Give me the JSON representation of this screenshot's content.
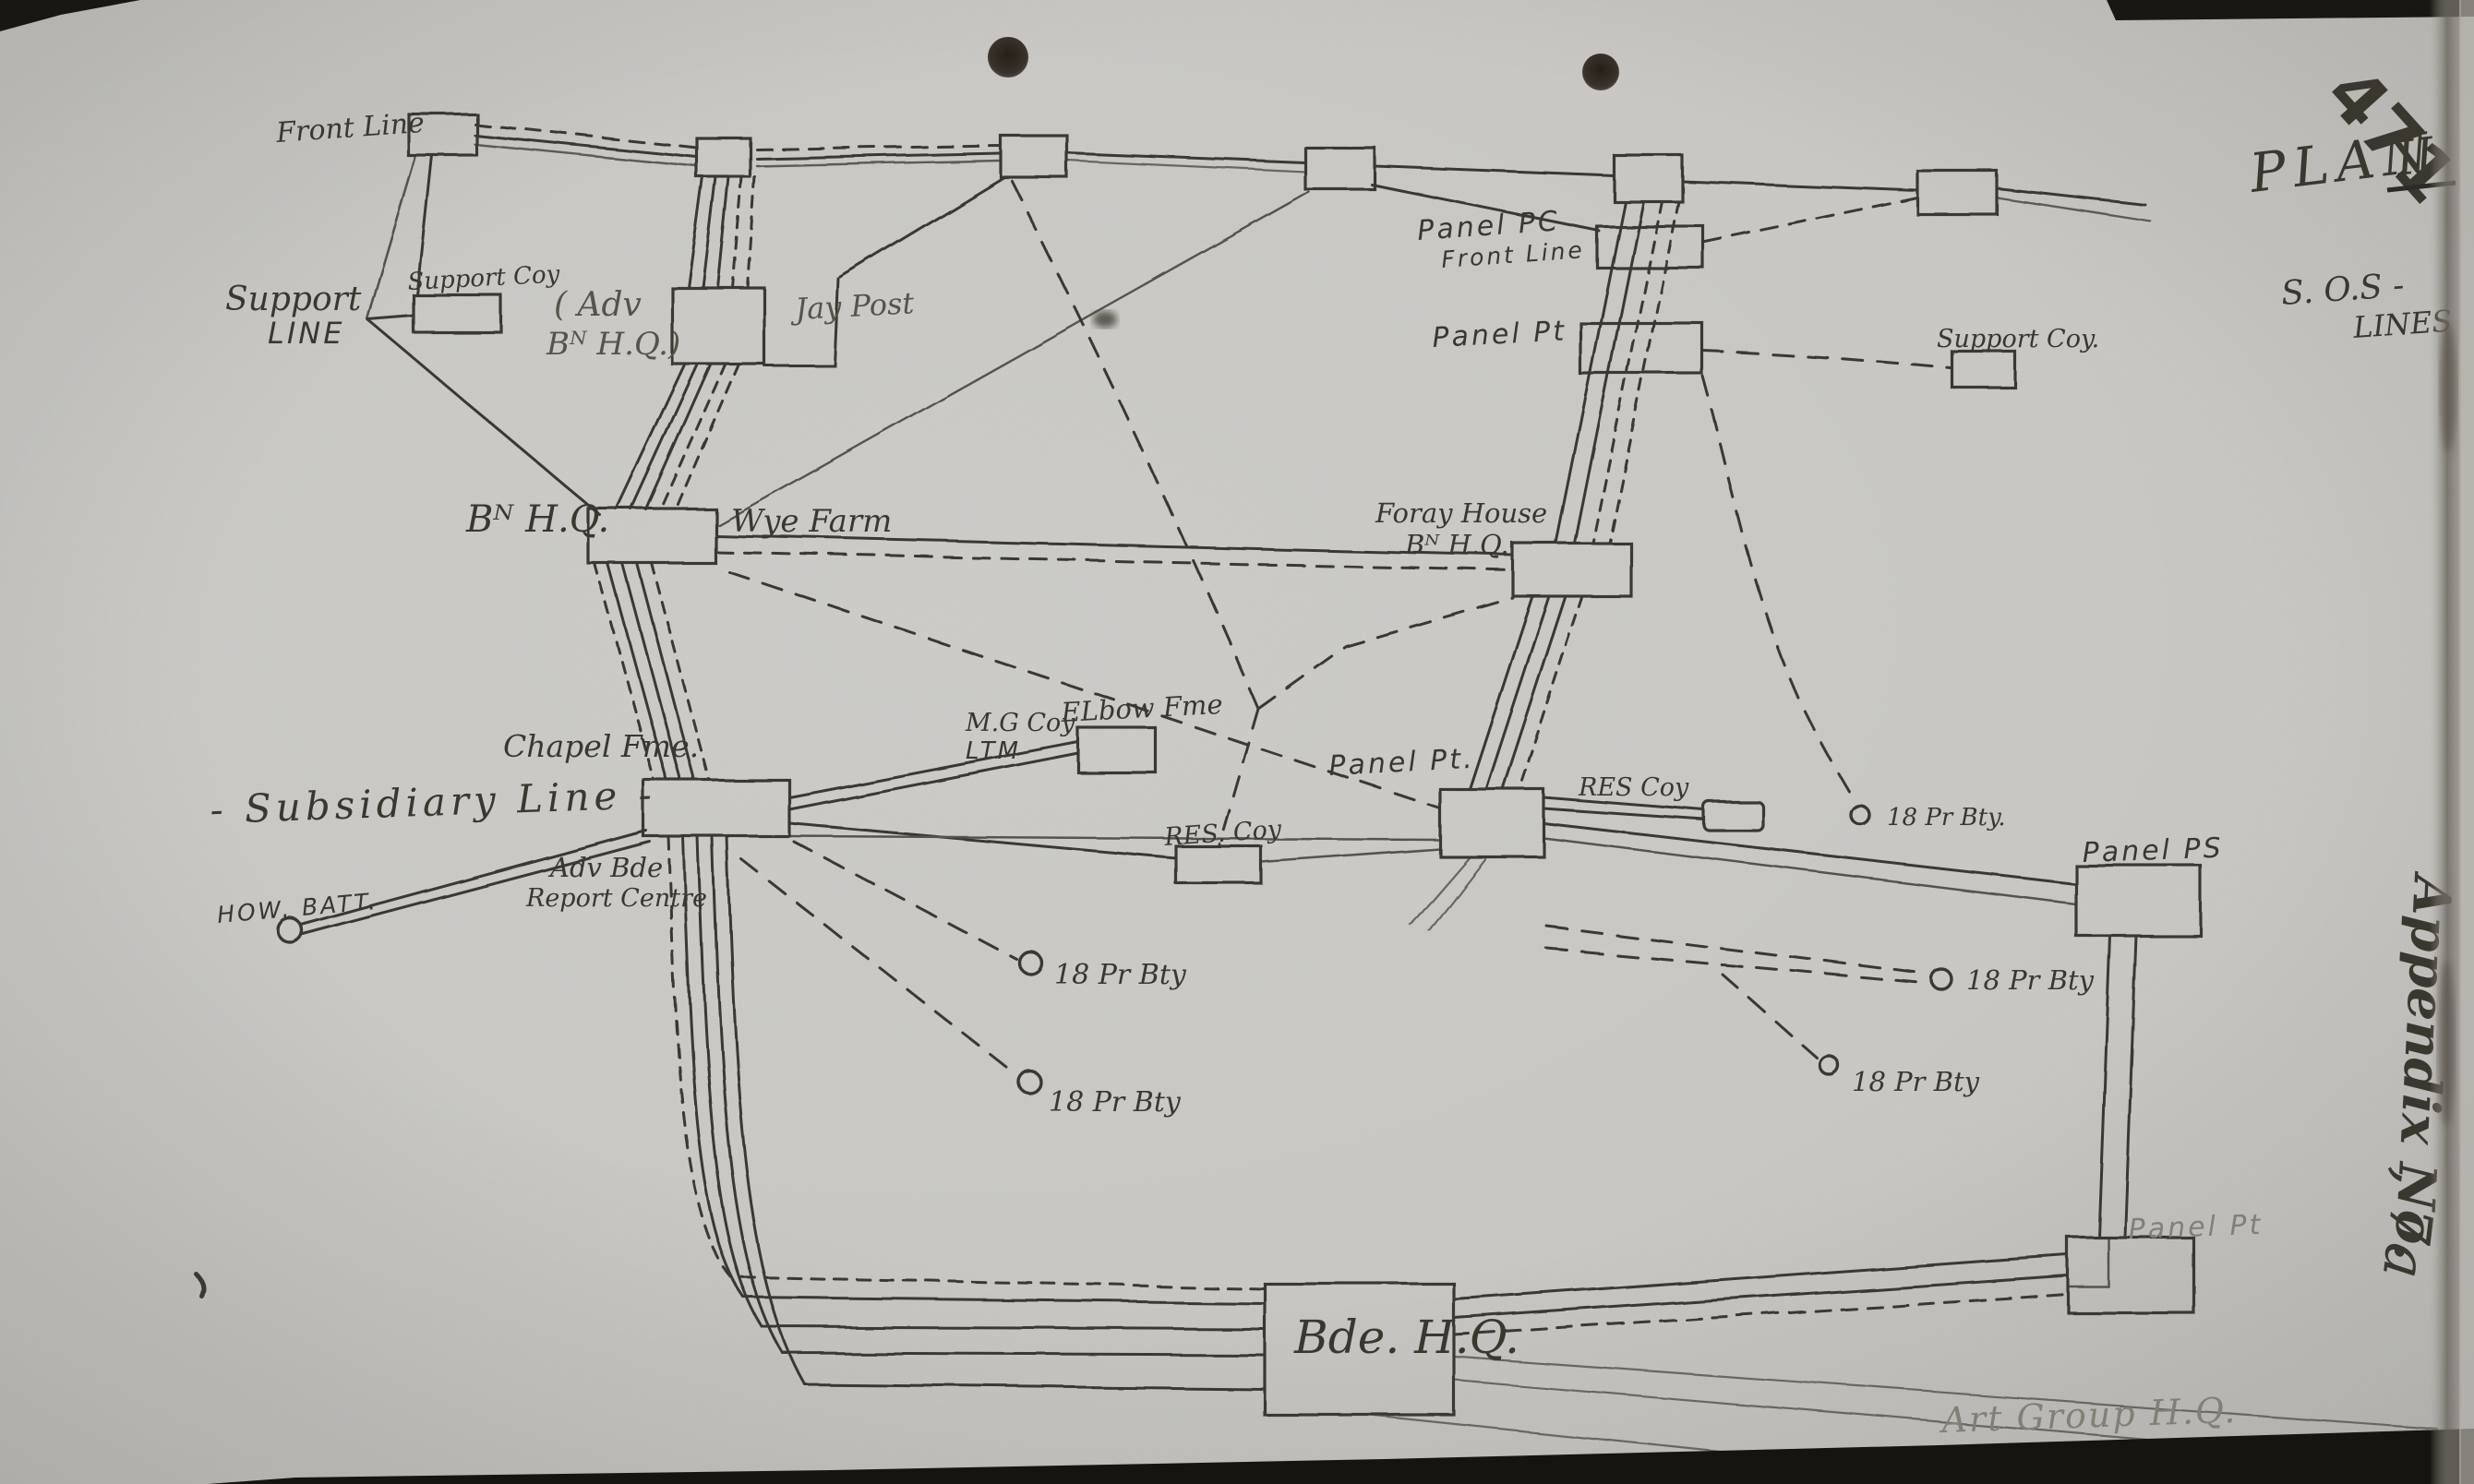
{
  "header": {
    "sheet_number": "471",
    "plan_label": "PLAN",
    "plan_numeral": "II",
    "sos_line_1": "S. O.S  -",
    "sos_line_2": "LINES"
  },
  "side_margin": {
    "appendix_label": "Appendix No.",
    "appendix_number": ", 7a",
    "bottom_corner_mark": "6"
  },
  "diagram": {
    "labels": {
      "front_line": "Front Line",
      "support_line_line1": "Support",
      "support_line_line2": "LINE",
      "support_coy_left": "Support Coy",
      "adv_bn_hq_line1": "( Adv",
      "adv_bn_hq_line2": "Bᴺ H.Q.)",
      "jay_post": "Jay Post",
      "panel_pc_line1": "Panel PC",
      "panel_pc_line2": "Front Line",
      "panel_pt_upper": "Panel Pt",
      "support_coy_right": "Support Coy.",
      "bn_hq": "Bᴺ H.Q.",
      "wye_farm": "Wye Farm",
      "foray_house_line1": "Foray House",
      "foray_house_line2": "Bᴺ H.Q.",
      "chapel_fme": "Chapel Fme.",
      "mg_coy_line1": "M.G Coy",
      "mg_coy_line2": "LTM",
      "elbow_fme": "ELbow Fme",
      "panel_pt_mid": "Panel Pt.",
      "res_coy_right": "RES Coy",
      "bty_res": "18 Pr Bty.",
      "res_coy_mid": "RES. Coy",
      "panel_ps": "Panel PS",
      "subsidiary_line": "- Subsidiary Line -",
      "adv_bde_line1": "Adv Bde",
      "adv_bde_line2": "Report Centre",
      "how_batt": "HOW. BATT.",
      "bty_left_upper": "18 Pr Bty",
      "bty_left_lower": "18 Pr Bty",
      "bty_right_upper": "18 Pr Bty",
      "bty_right_lower": "18 Pr Bty",
      "panel_pt_bottom": "Panel Pt",
      "bde_hq": "Bde. H.Q.",
      "art_group_hq": "Art Group H.Q."
    }
  }
}
